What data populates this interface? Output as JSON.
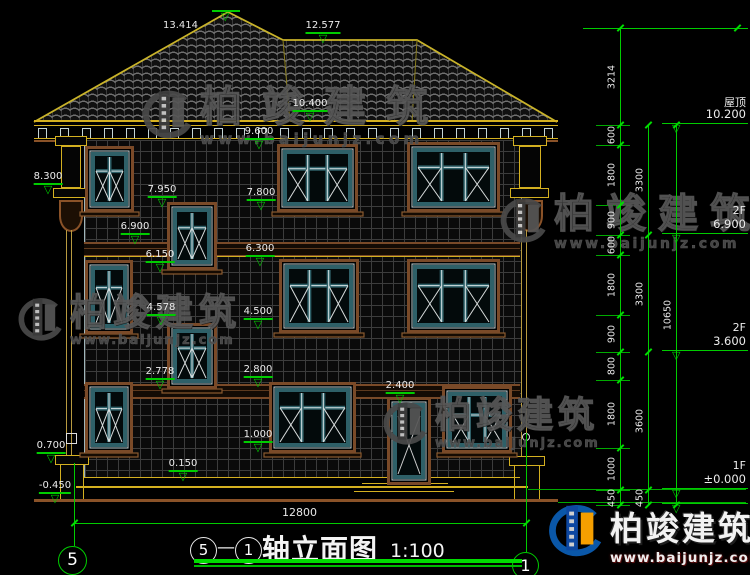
{
  "meta": {
    "axis_from": "5",
    "axis_to": "1",
    "dash": "—",
    "drawing_title": "轴立面图",
    "scale": "1:100"
  },
  "watermark": {
    "brand": "柏竣建筑",
    "url": "www.baijunjz.com"
  },
  "floor_levels": [
    {
      "name": "屋顶",
      "value": "10.200",
      "y": 125
    },
    {
      "name": "2F",
      "value": "6.900",
      "y": 235
    },
    {
      "name": "2F",
      "value": "3.600",
      "y": 352
    },
    {
      "name": "1F",
      "value": "±0.000",
      "y": 490
    },
    {
      "name": "",
      "value": "",
      "y": 505
    }
  ],
  "dim_chains": [
    {
      "x": 620,
      "levels": [
        28,
        125,
        145,
        205,
        235,
        255,
        315,
        352,
        380,
        448,
        490,
        505
      ],
      "labels": [
        "3214",
        "600",
        "1800",
        "900",
        "600",
        "1800",
        "900",
        "800",
        "1800",
        "1000",
        "450"
      ]
    },
    {
      "x": 648,
      "levels": [
        125,
        235,
        352,
        490,
        505
      ],
      "labels": [
        "3300",
        "3300",
        "3600",
        "450"
      ]
    },
    {
      "x": 676,
      "levels": [
        125,
        505
      ],
      "labels": [
        "10650"
      ]
    }
  ],
  "top_level_line": {
    "y": 28,
    "x1": 583,
    "x2": 748
  },
  "bottom_dim": {
    "label": "12800",
    "x1": 74,
    "x2": 526,
    "y": 523
  },
  "axis_lines": [
    {
      "x": 74,
      "y1": 463,
      "y2": 546
    },
    {
      "x": 526,
      "y1": 433,
      "y2": 552
    }
  ],
  "axis_bubbles": [
    {
      "label": "5",
      "cx": 73,
      "cy": 561,
      "r": 15
    },
    {
      "label": "1",
      "cx": 526,
      "cy": 566,
      "r": 14
    }
  ],
  "elevation_markers": [
    {
      "label": "13.414",
      "cx": 180,
      "cy": 20,
      "tri_cx": 226,
      "tri_y": 10
    },
    {
      "label": "12.577",
      "cx": 323,
      "cy": 21
    },
    {
      "label": "10.400",
      "cx": 310,
      "cy": 99
    },
    {
      "label": "9.600",
      "cx": 259,
      "cy": 127
    },
    {
      "label": "8.300",
      "cx": 48,
      "cy": 172
    },
    {
      "label": "7.950",
      "cx": 162,
      "cy": 185
    },
    {
      "label": "7.800",
      "cx": 261,
      "cy": 188
    },
    {
      "label": "6.900",
      "cx": 135,
      "cy": 222
    },
    {
      "label": "6.300",
      "cx": 260,
      "cy": 244
    },
    {
      "label": "6.150",
      "cx": 160,
      "cy": 250
    },
    {
      "label": "4.578",
      "cx": 161,
      "cy": 303
    },
    {
      "label": "4.500",
      "cx": 258,
      "cy": 307
    },
    {
      "label": "2.800",
      "cx": 258,
      "cy": 365
    },
    {
      "label": "2.778",
      "cx": 160,
      "cy": 367
    },
    {
      "label": "2.400",
      "cx": 400,
      "cy": 381
    },
    {
      "label": "1.000",
      "cx": 258,
      "cy": 430
    },
    {
      "label": "0.700",
      "cx": 51,
      "cy": 441
    },
    {
      "label": "0.150",
      "cx": 183,
      "cy": 459
    },
    {
      "label": "-0.450",
      "cx": 55,
      "cy": 481
    }
  ],
  "windows": [
    {
      "id": "window-3f-left",
      "x": 85,
      "y": 146,
      "w": 49,
      "h": 66,
      "type": "casement2"
    },
    {
      "id": "window-3f-stair",
      "x": 167,
      "y": 202,
      "w": 50,
      "h": 68,
      "type": "stair2"
    },
    {
      "id": "window-3f-mid",
      "x": 277,
      "y": 144,
      "w": 81,
      "h": 68,
      "type": "wide3"
    },
    {
      "id": "window-3f-right",
      "x": 407,
      "y": 142,
      "w": 93,
      "h": 70,
      "type": "wide3"
    },
    {
      "id": "window-2f-left",
      "x": 85,
      "y": 260,
      "w": 48,
      "h": 74,
      "type": "casement2"
    },
    {
      "id": "window-2f-stair",
      "x": 167,
      "y": 323,
      "w": 50,
      "h": 66,
      "type": "stair2"
    },
    {
      "id": "window-2f-mid",
      "x": 279,
      "y": 259,
      "w": 80,
      "h": 74,
      "type": "wide3"
    },
    {
      "id": "window-2f-right",
      "x": 407,
      "y": 259,
      "w": 93,
      "h": 74,
      "type": "wide3"
    },
    {
      "id": "window-1f-left",
      "x": 85,
      "y": 382,
      "w": 48,
      "h": 71,
      "type": "casement2"
    },
    {
      "id": "window-1f-mid",
      "x": 269,
      "y": 382,
      "w": 87,
      "h": 71,
      "type": "wide3"
    },
    {
      "id": "window-1f-right",
      "x": 442,
      "y": 386,
      "w": 70,
      "h": 67,
      "type": "transom3"
    }
  ],
  "door": {
    "id": "entry-door",
    "x": 387,
    "y": 397,
    "w": 44,
    "h": 88
  },
  "watermarks_gray": [
    {
      "x": 140,
      "y": 86,
      "font": 42,
      "ls": 20,
      "logo": 54
    },
    {
      "x": 498,
      "y": 194,
      "font": 40,
      "ls": 12,
      "logo": 50
    },
    {
      "x": 16,
      "y": 294,
      "font": 37,
      "ls": 6,
      "logo": 48
    },
    {
      "x": 381,
      "y": 398,
      "font": 36,
      "ls": 5,
      "logo": 48
    }
  ],
  "brand_footer": {
    "x": 546,
    "y": 500
  }
}
